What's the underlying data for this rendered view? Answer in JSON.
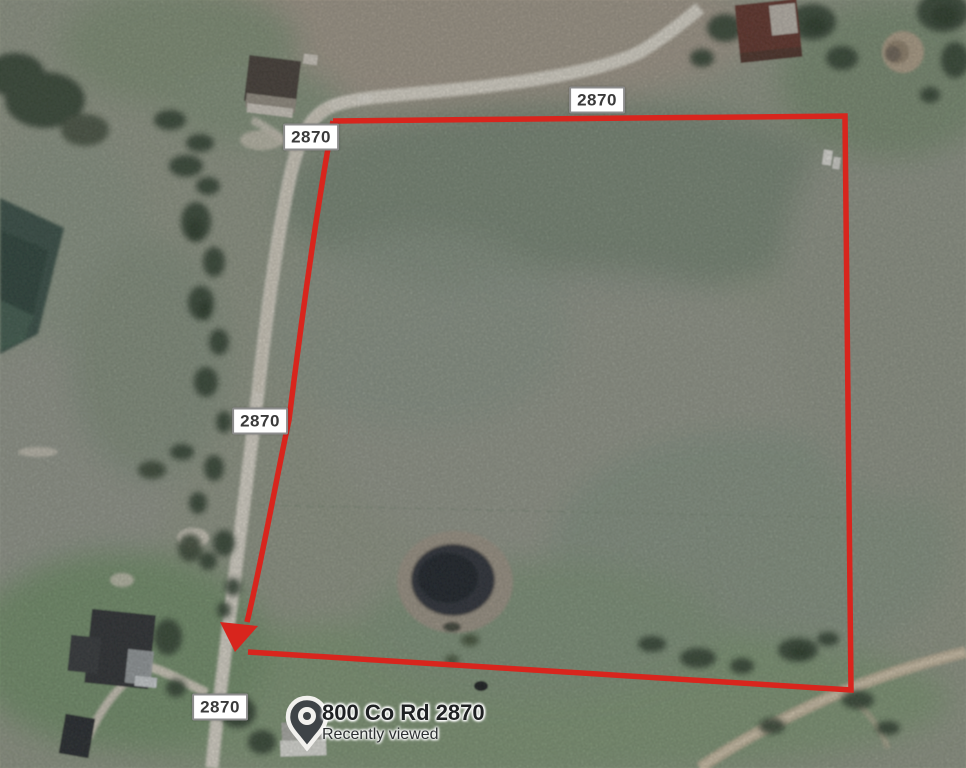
{
  "map": {
    "road_labels": [
      {
        "label": "2870"
      },
      {
        "label": "2870"
      },
      {
        "label": "2870"
      },
      {
        "label": "2870"
      }
    ],
    "pin": {
      "title": "800 Co Rd 2870",
      "subtitle": "Recently viewed"
    },
    "colors": {
      "boundary": "#d8251d",
      "badge_background": "#ffffff",
      "badge_border": "#8c8c8c",
      "badge_text": "#3a3a3a",
      "pin_fill": "#3e4347",
      "pin_outline": "#f2f1ee"
    }
  }
}
